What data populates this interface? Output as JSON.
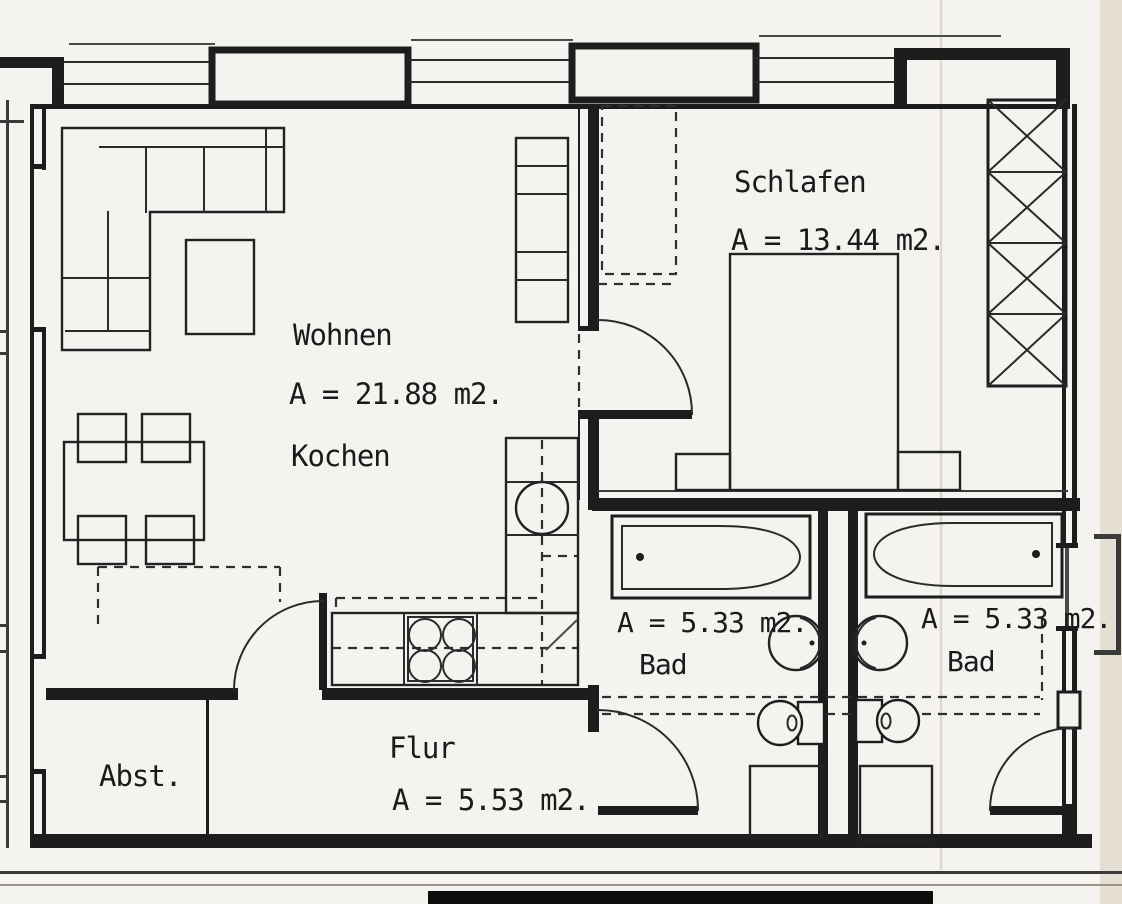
{
  "plan": {
    "language": "de",
    "rooms": {
      "wohnen": {
        "name": "Wohnen",
        "area": "A = 21.88 m2."
      },
      "kochen": {
        "name": "Kochen"
      },
      "schlafen": {
        "name": "Schlafen",
        "area": "A = 13.44 m2."
      },
      "bad_left": {
        "name": "Bad",
        "area": "A = 5.33 m2."
      },
      "bad_right": {
        "name": "Bad",
        "area": "A = 5.33 m2."
      },
      "flur": {
        "name": "Flur",
        "area": "A = 5.53 m2."
      },
      "abstellraum": {
        "name": "Abst."
      }
    },
    "colors": {
      "paper": "#f5f3ef",
      "ink": "#1d1d1d"
    }
  }
}
